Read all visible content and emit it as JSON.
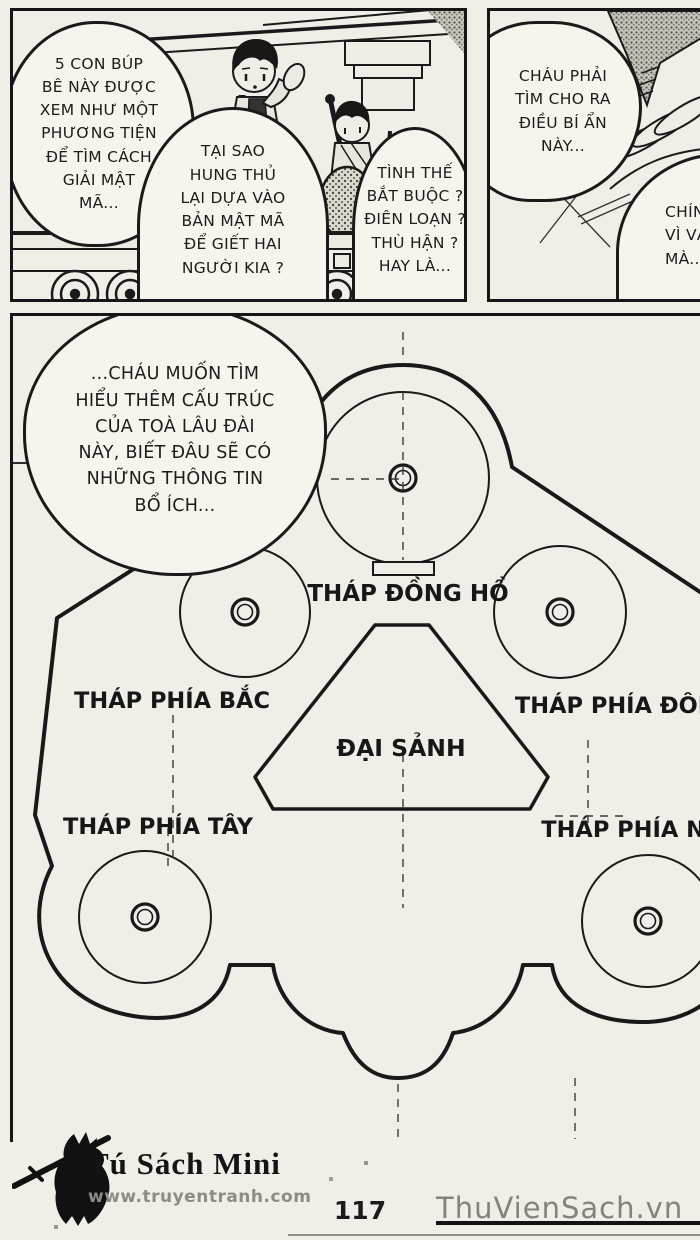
{
  "colors": {
    "paper": "#f0eee7",
    "ink": "#1a1a1a",
    "muted_gray": "#84827a"
  },
  "panel_top_left": {
    "bubble_1": "5 CON BÚP\nBÊ NÀY ĐƯỢC\nXEM NHƯ MỘT\nPHƯƠNG TIỆN\nĐỂ TÌM CÁCH\nGIẢI MẬT\nMÃ...",
    "bubble_2": "TẠI SAO\nHUNG THỦ\nLẠI DỰA VÀO\nBẢN MẬT MÃ\nĐỂ GIẾT HAI\nNGƯỜI KIA ?",
    "bubble_3": "TÌNH THẾ\nBẮT BUỘC ?\nĐIÊN LOẠN ?\nTHÙ HẬN ?\nHAY LÀ..."
  },
  "panel_top_right": {
    "bubble_1": "CHÁU PHẢI\nTÌM CHO RA\nĐIỀU BÍ ẨN\nNÀY...",
    "bubble_2": "CHÍN\nVÌ VẬ\nMÀ..."
  },
  "panel_floorplan": {
    "bubble": "...CHÁU MUỐN TÌM\nHIỂU THÊM CẤU TRÚC\nCỦA TOÀ LÂU ĐÀI\nNÀY, BIẾT ĐÂU SẼ CÓ\nNHỮNG THÔNG TIN\nBỔ ÍCH...",
    "labels": {
      "clock_tower": "THÁP ĐỒNG HỒ",
      "north_tower": "THÁP PHÍA BẮC",
      "east_tower": "THÁP PHÍA ĐÔNG",
      "great_hall": "ĐẠI SẢNH",
      "west_tower": "THÁP PHÍA TÂY",
      "south_tower": "THÁP PHÍA NAM"
    }
  },
  "footer": {
    "publisher": "Tú Sách Mini",
    "website": "www.truyentranh.com",
    "page_number": "117",
    "watermark": "ThuVienSach.vn"
  }
}
